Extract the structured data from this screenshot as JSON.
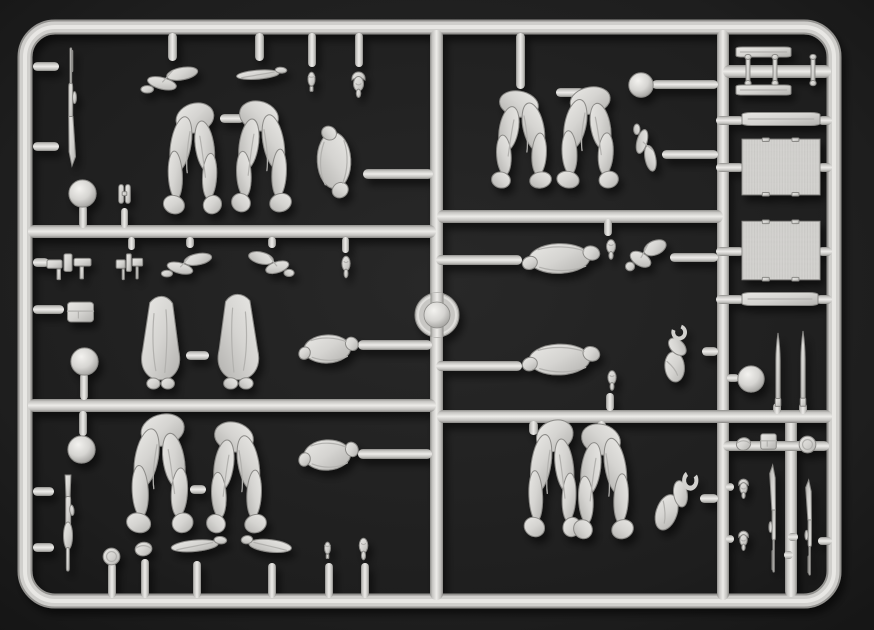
{
  "scene": {
    "type": "photograph",
    "subject": "injection-molded plastic model sprue with soldier figure parts",
    "background_color": "#1e1e1e",
    "plastic_color": "#d3d2cf",
    "plastic_highlight": "#edece9",
    "plastic_shadow": "#8f8e8b"
  },
  "sprue": {
    "frame": {
      "x": 25,
      "y": 27,
      "w": 809,
      "h": 574,
      "corner_radius": 30,
      "thickness": 14
    },
    "medallion": {
      "cx": 437,
      "cy": 315,
      "r_outer": 22,
      "r_inner": 13
    },
    "runners": [
      {
        "x": 430,
        "y": 30,
        "w": 13,
        "h": 570
      },
      {
        "x": 717,
        "y": 30,
        "w": 12,
        "h": 570
      },
      {
        "x": 785,
        "y": 412,
        "w": 12,
        "h": 185
      },
      {
        "x": 28,
        "y": 225,
        "w": 408,
        "h": 13
      },
      {
        "x": 28,
        "y": 399,
        "w": 408,
        "h": 13
      },
      {
        "x": 437,
        "y": 210,
        "w": 286,
        "h": 13
      },
      {
        "x": 437,
        "y": 410,
        "w": 395,
        "h": 13
      },
      {
        "x": 723,
        "y": 65,
        "w": 108,
        "h": 13
      },
      {
        "x": 723,
        "y": 441,
        "w": 106,
        "h": 10
      }
    ],
    "stubs": [
      {
        "x": 33,
        "y": 62,
        "w": 26,
        "h": 9
      },
      {
        "x": 33,
        "y": 142,
        "w": 26,
        "h": 9
      },
      {
        "x": 79,
        "y": 205,
        "w": 8,
        "h": 23
      },
      {
        "x": 121,
        "y": 208,
        "w": 7,
        "h": 20
      },
      {
        "x": 168,
        "y": 33,
        "w": 9,
        "h": 28
      },
      {
        "x": 255,
        "y": 33,
        "w": 9,
        "h": 28
      },
      {
        "x": 308,
        "y": 33,
        "w": 8,
        "h": 34
      },
      {
        "x": 355,
        "y": 33,
        "w": 8,
        "h": 34
      },
      {
        "x": 220,
        "y": 114,
        "w": 24,
        "h": 9
      },
      {
        "x": 363,
        "y": 169,
        "w": 70,
        "h": 10
      },
      {
        "x": 516,
        "y": 33,
        "w": 9,
        "h": 56
      },
      {
        "x": 556,
        "y": 88,
        "w": 28,
        "h": 9
      },
      {
        "x": 652,
        "y": 80,
        "w": 66,
        "h": 9
      },
      {
        "x": 662,
        "y": 150,
        "w": 56,
        "h": 9
      },
      {
        "x": 604,
        "y": 219,
        "w": 8,
        "h": 17
      },
      {
        "x": 436,
        "y": 255,
        "w": 86,
        "h": 10
      },
      {
        "x": 436,
        "y": 361,
        "w": 86,
        "h": 10
      },
      {
        "x": 670,
        "y": 253,
        "w": 48,
        "h": 9
      },
      {
        "x": 702,
        "y": 347,
        "w": 16,
        "h": 9
      },
      {
        "x": 606,
        "y": 393,
        "w": 8,
        "h": 18
      },
      {
        "x": 358,
        "y": 340,
        "w": 74,
        "h": 10
      },
      {
        "x": 358,
        "y": 449,
        "w": 74,
        "h": 10
      },
      {
        "x": 33,
        "y": 258,
        "w": 16,
        "h": 9
      },
      {
        "x": 33,
        "y": 305,
        "w": 31,
        "h": 9
      },
      {
        "x": 80,
        "y": 373,
        "w": 8,
        "h": 27
      },
      {
        "x": 79,
        "y": 411,
        "w": 8,
        "h": 25
      },
      {
        "x": 33,
        "y": 487,
        "w": 21,
        "h": 9
      },
      {
        "x": 33,
        "y": 543,
        "w": 21,
        "h": 9
      },
      {
        "x": 128,
        "y": 237,
        "w": 7,
        "h": 13
      },
      {
        "x": 186,
        "y": 237,
        "w": 8,
        "h": 11
      },
      {
        "x": 268,
        "y": 237,
        "w": 8,
        "h": 11
      },
      {
        "x": 342,
        "y": 237,
        "w": 7,
        "h": 16
      },
      {
        "x": 186,
        "y": 351,
        "w": 23,
        "h": 9
      },
      {
        "x": 190,
        "y": 485,
        "w": 16,
        "h": 9
      },
      {
        "x": 529,
        "y": 421,
        "w": 9,
        "h": 14
      },
      {
        "x": 597,
        "y": 421,
        "w": 9,
        "h": 14
      },
      {
        "x": 700,
        "y": 494,
        "w": 18,
        "h": 9
      },
      {
        "x": 108,
        "y": 563,
        "w": 8,
        "h": 35
      },
      {
        "x": 141,
        "y": 559,
        "w": 8,
        "h": 39
      },
      {
        "x": 193,
        "y": 561,
        "w": 8,
        "h": 37
      },
      {
        "x": 268,
        "y": 563,
        "w": 8,
        "h": 35
      },
      {
        "x": 325,
        "y": 563,
        "w": 8,
        "h": 35
      },
      {
        "x": 361,
        "y": 563,
        "w": 8,
        "h": 35
      },
      {
        "x": 716,
        "y": 116,
        "w": 28,
        "h": 9
      },
      {
        "x": 818,
        "y": 116,
        "w": 14,
        "h": 9
      },
      {
        "x": 716,
        "y": 163,
        "w": 28,
        "h": 9
      },
      {
        "x": 818,
        "y": 163,
        "w": 14,
        "h": 9
      },
      {
        "x": 716,
        "y": 247,
        "w": 28,
        "h": 9
      },
      {
        "x": 818,
        "y": 247,
        "w": 14,
        "h": 9
      },
      {
        "x": 716,
        "y": 295,
        "w": 28,
        "h": 9
      },
      {
        "x": 816,
        "y": 295,
        "w": 16,
        "h": 9
      },
      {
        "x": 727,
        "y": 374,
        "w": 12,
        "h": 8
      },
      {
        "x": 773,
        "y": 403,
        "w": 8,
        "h": 11
      },
      {
        "x": 799,
        "y": 403,
        "w": 8,
        "h": 11
      },
      {
        "x": 726,
        "y": 483,
        "w": 8,
        "h": 8
      },
      {
        "x": 726,
        "y": 535,
        "w": 8,
        "h": 8
      },
      {
        "x": 784,
        "y": 551,
        "w": 9,
        "h": 8
      },
      {
        "x": 788,
        "y": 533,
        "w": 10,
        "h": 8
      },
      {
        "x": 818,
        "y": 537,
        "w": 14,
        "h": 8
      }
    ],
    "parts": [
      {
        "id": "rifle-top-left",
        "type": "rifle",
        "x": 55,
        "y": 48,
        "w": 32,
        "h": 118
      },
      {
        "id": "helmet-left-1",
        "type": "helmet",
        "x": 68,
        "y": 179,
        "w": 29,
        "h": 29
      },
      {
        "id": "binoculars-left",
        "type": "binoculars",
        "x": 113,
        "y": 180,
        "w": 23,
        "h": 31
      },
      {
        "id": "arm-hanging-1",
        "type": "arm",
        "x": 136,
        "y": 58,
        "w": 70,
        "h": 46
      },
      {
        "id": "forearm-hanging",
        "type": "forearm",
        "x": 230,
        "y": 58,
        "w": 58,
        "h": 32
      },
      {
        "id": "grenade-hanging",
        "type": "grenade",
        "x": 299,
        "y": 64,
        "w": 25,
        "h": 36
      },
      {
        "id": "head-hanging-1",
        "type": "head_helmet",
        "x": 343,
        "y": 64,
        "w": 31,
        "h": 38
      },
      {
        "id": "legs-running-1",
        "type": "legs_pair",
        "x": 155,
        "y": 102,
        "w": 70,
        "h": 114
      },
      {
        "id": "legs-running-2",
        "type": "legs_pair",
        "x": 228,
        "y": 100,
        "w": 72,
        "h": 114,
        "flip": true
      },
      {
        "id": "torso-greatcoat-1",
        "type": "torso",
        "x": 303,
        "y": 124,
        "w": 62,
        "h": 76,
        "rot": 90
      },
      {
        "id": "legs-standing-1",
        "type": "legs_pair",
        "x": 488,
        "y": 90,
        "w": 72,
        "h": 100,
        "flip": true
      },
      {
        "id": "legs-standing-2",
        "type": "legs_pair",
        "x": 548,
        "y": 86,
        "w": 74,
        "h": 104
      },
      {
        "id": "helmet-center-1",
        "type": "helmet",
        "x": 628,
        "y": 72,
        "w": 26,
        "h": 26
      },
      {
        "id": "arm-bent-row1",
        "type": "arm",
        "x": 624,
        "y": 120,
        "w": 40,
        "h": 58,
        "rot": 90
      },
      {
        "id": "rack-bar-1",
        "type": "bar",
        "x": 736,
        "y": 45,
        "w": 55,
        "h": 14
      },
      {
        "id": "post-1",
        "type": "post",
        "x": 741,
        "y": 54,
        "w": 14,
        "h": 32
      },
      {
        "id": "post-2",
        "type": "post",
        "x": 768,
        "y": 54,
        "w": 14,
        "h": 32
      },
      {
        "id": "post-3",
        "type": "post",
        "x": 806,
        "y": 54,
        "w": 14,
        "h": 32
      },
      {
        "id": "rack-bar-2",
        "type": "bar",
        "x": 736,
        "y": 83,
        "w": 55,
        "h": 14
      },
      {
        "id": "plank-1",
        "type": "bar",
        "x": 742,
        "y": 110,
        "w": 78,
        "h": 18
      },
      {
        "id": "tarp-panel-1",
        "type": "panel",
        "x": 742,
        "y": 138,
        "w": 78,
        "h": 58
      },
      {
        "id": "torso-row2-1",
        "type": "torso",
        "x": 520,
        "y": 231,
        "w": 82,
        "h": 55
      },
      {
        "id": "head-row2-1",
        "type": "head",
        "x": 598,
        "y": 235,
        "w": 26,
        "h": 30
      },
      {
        "id": "arm-row2-1",
        "type": "arm",
        "x": 622,
        "y": 229,
        "w": 50,
        "h": 55
      },
      {
        "id": "torso-row2-2",
        "type": "torso",
        "x": 520,
        "y": 331,
        "w": 82,
        "h": 57
      },
      {
        "id": "head-row2-2",
        "type": "head",
        "x": 600,
        "y": 366,
        "w": 24,
        "h": 30
      },
      {
        "id": "arm-row2-2",
        "type": "arm_open",
        "x": 650,
        "y": 326,
        "w": 54,
        "h": 56,
        "rot": -20
      },
      {
        "id": "tarp-panel-2",
        "type": "panel",
        "x": 742,
        "y": 220,
        "w": 78,
        "h": 61
      },
      {
        "id": "plank-2",
        "type": "bar",
        "x": 742,
        "y": 290,
        "w": 76,
        "h": 18
      },
      {
        "id": "helmet-right-1",
        "type": "helmet",
        "x": 737,
        "y": 365,
        "w": 28,
        "h": 28
      },
      {
        "id": "shell-1",
        "type": "shell",
        "x": 770,
        "y": 333,
        "w": 16,
        "h": 78
      },
      {
        "id": "shell-2",
        "type": "shell",
        "x": 795,
        "y": 331,
        "w": 16,
        "h": 80
      },
      {
        "id": "gun-parts-cluster",
        "type": "smallparts",
        "x": 45,
        "y": 247,
        "w": 50,
        "h": 38
      },
      {
        "id": "pouch-left",
        "type": "pouch",
        "x": 63,
        "y": 297,
        "w": 35,
        "h": 30
      },
      {
        "id": "helmet-left-2",
        "type": "helmet",
        "x": 70,
        "y": 347,
        "w": 29,
        "h": 29
      },
      {
        "id": "small-part-hanging",
        "type": "smallparts",
        "x": 115,
        "y": 247,
        "w": 30,
        "h": 38
      },
      {
        "id": "arm-rowb-1",
        "type": "arm",
        "x": 157,
        "y": 245,
        "w": 62,
        "h": 42
      },
      {
        "id": "arm-rowb-2",
        "type": "arm",
        "x": 242,
        "y": 243,
        "w": 56,
        "h": 44,
        "flip": true
      },
      {
        "id": "head-rowb",
        "type": "head",
        "x": 334,
        "y": 251,
        "w": 24,
        "h": 33
      },
      {
        "id": "greatcoat-1",
        "type": "greatcoat",
        "x": 130,
        "y": 297,
        "w": 60,
        "h": 92
      },
      {
        "id": "greatcoat-2",
        "type": "greatcoat",
        "x": 207,
        "y": 295,
        "w": 64,
        "h": 94,
        "flip": true
      },
      {
        "id": "torso-rowb",
        "type": "torso",
        "x": 297,
        "y": 323,
        "w": 63,
        "h": 52
      },
      {
        "id": "helmet-left-3",
        "type": "helmet",
        "x": 67,
        "y": 435,
        "w": 29,
        "h": 29
      },
      {
        "id": "smg-left",
        "type": "smg",
        "x": 52,
        "y": 473,
        "w": 32,
        "h": 98
      },
      {
        "id": "legs-seated-1",
        "type": "legs_pair",
        "x": 117,
        "y": 413,
        "w": 80,
        "h": 122
      },
      {
        "id": "legs-seated-2",
        "type": "legs_pair",
        "x": 203,
        "y": 421,
        "w": 72,
        "h": 114,
        "flip": true
      },
      {
        "id": "torso-rowc",
        "type": "torso",
        "x": 297,
        "y": 427,
        "w": 63,
        "h": 56
      },
      {
        "id": "disc-bottom",
        "type": "disc",
        "x": 102,
        "y": 547,
        "w": 19,
        "h": 19
      },
      {
        "id": "cap-bottom",
        "type": "cap",
        "x": 130,
        "y": 535,
        "w": 27,
        "h": 27
      },
      {
        "id": "arm-bottom-1",
        "type": "forearm",
        "x": 164,
        "y": 525,
        "w": 64,
        "h": 40
      },
      {
        "id": "arm-bottom-2",
        "type": "forearm",
        "x": 240,
        "y": 523,
        "w": 58,
        "h": 44,
        "flip": true
      },
      {
        "id": "head-bottom-1",
        "type": "grenade",
        "x": 317,
        "y": 535,
        "w": 21,
        "h": 31
      },
      {
        "id": "head-bottom-2",
        "type": "head",
        "x": 351,
        "y": 533,
        "w": 25,
        "h": 33
      },
      {
        "id": "legs-kneeling-1",
        "type": "legs_pair",
        "x": 516,
        "y": 419,
        "w": 68,
        "h": 120
      },
      {
        "id": "legs-kneeling-2",
        "type": "legs_pair",
        "x": 570,
        "y": 423,
        "w": 72,
        "h": 118,
        "flip": true
      },
      {
        "id": "arm-row3",
        "type": "arm_open",
        "x": 648,
        "y": 466,
        "w": 56,
        "h": 70,
        "rot": 15
      },
      {
        "id": "cap-right",
        "type": "cap",
        "x": 732,
        "y": 431,
        "w": 23,
        "h": 25
      },
      {
        "id": "pouch-right",
        "type": "pouch",
        "x": 758,
        "y": 430,
        "w": 21,
        "h": 23
      },
      {
        "id": "disc-right",
        "type": "disc",
        "x": 798,
        "y": 435,
        "w": 19,
        "h": 19
      },
      {
        "id": "head-right-1",
        "type": "head_helmet",
        "x": 732,
        "y": 473,
        "w": 23,
        "h": 29
      },
      {
        "id": "head-right-2",
        "type": "head_helmet",
        "x": 732,
        "y": 525,
        "w": 23,
        "h": 29
      },
      {
        "id": "rifle-right-1",
        "type": "rifle",
        "x": 760,
        "y": 465,
        "w": 27,
        "h": 107,
        "rot": 180
      },
      {
        "id": "rifle-right-2",
        "type": "rifle",
        "x": 796,
        "y": 480,
        "w": 27,
        "h": 95,
        "rot": 180
      }
    ]
  }
}
